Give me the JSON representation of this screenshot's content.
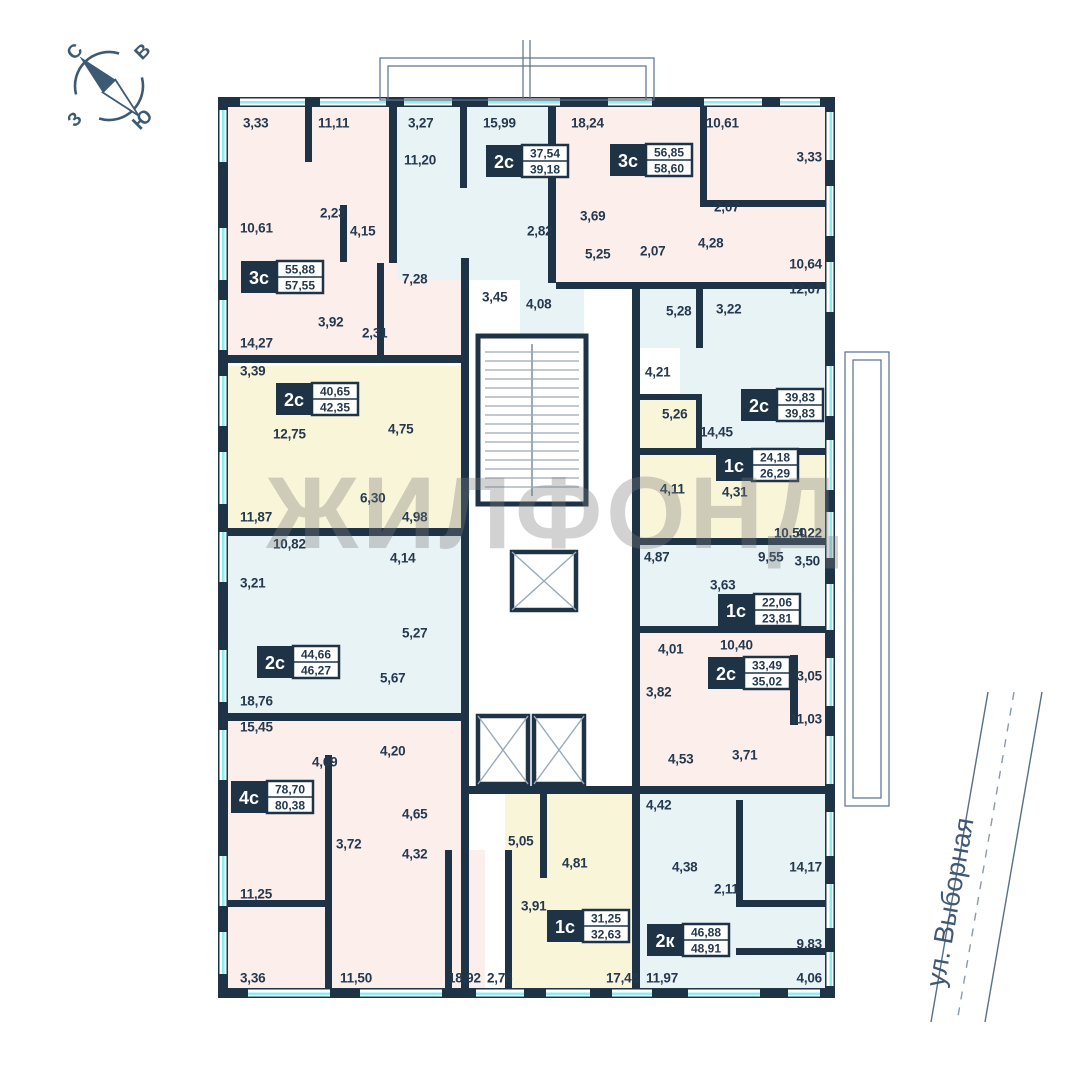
{
  "watermark": "ЖИЛФОНД",
  "street": {
    "name": "ул. Выборная"
  },
  "compass": {
    "north": "С",
    "east": "В",
    "south": "Ю",
    "west": "З"
  },
  "colors": {
    "wall": "#1f3347",
    "pink": "#fcefeb",
    "blue": "#e8f3f5",
    "yellow": "#f9f5d9",
    "glass": "#8ceef0",
    "text": "#24384e",
    "line": "#56708a",
    "stair": "#9aa9b8",
    "white": "#ffffff"
  },
  "plan": {
    "apartments": [
      {
        "type": "3с",
        "area_upper": "55,88",
        "area_lower": "57,55",
        "color": "pink",
        "bx": 283,
        "by": 277,
        "regions": [
          [
            222,
            100,
            171,
            258
          ],
          [
            340,
            205,
            128,
            153
          ]
        ]
      },
      {
        "type": "2с",
        "area_upper": "37,54",
        "area_lower": "39,18",
        "color": "blue",
        "bx": 528,
        "by": 161,
        "regions": [
          [
            397,
            100,
            151,
            85
          ],
          [
            397,
            185,
            155,
            95
          ],
          [
            520,
            280,
            64,
            55
          ]
        ]
      },
      {
        "type": "3с",
        "area_upper": "56,85",
        "area_lower": "58,60",
        "color": "pink",
        "bx": 652,
        "by": 160,
        "regions": [
          [
            556,
            100,
            269,
            182
          ]
        ]
      },
      {
        "type": "2с",
        "area_upper": "39,83",
        "area_lower": "39,83",
        "color": "blue",
        "bx": 783,
        "by": 405,
        "regions": [
          [
            640,
            286,
            185,
            62
          ],
          [
            680,
            348,
            145,
            104
          ]
        ]
      },
      {
        "type": "2с",
        "area_upper": "40,65",
        "area_lower": "42,35",
        "color": "yellow",
        "bx": 318,
        "by": 399,
        "regions": [
          [
            222,
            366,
            243,
            162
          ]
        ]
      },
      {
        "type": "1с",
        "area_upper": "24,18",
        "area_lower": "26,29",
        "color": "yellow",
        "bx": 758,
        "by": 465,
        "regions": [
          [
            638,
            400,
            62,
            52
          ],
          [
            640,
            452,
            185,
            88
          ]
        ]
      },
      {
        "type": "1с",
        "area_upper": "22,06",
        "area_lower": "23,81",
        "color": "blue",
        "bx": 760,
        "by": 610,
        "regions": [
          [
            640,
            540,
            185,
            86
          ]
        ]
      },
      {
        "type": "2с",
        "area_upper": "33,49",
        "area_lower": "35,02",
        "color": "pink",
        "bx": 750,
        "by": 673,
        "regions": [
          [
            640,
            626,
            185,
            160
          ]
        ]
      },
      {
        "type": "2с",
        "area_upper": "44,66",
        "area_lower": "46,27",
        "color": "blue",
        "bx": 299,
        "by": 662,
        "regions": [
          [
            222,
            536,
            243,
            177
          ]
        ]
      },
      {
        "type": "4с",
        "area_upper": "78,70",
        "area_lower": "80,38",
        "color": "pink",
        "bx": 273,
        "by": 797,
        "regions": [
          [
            222,
            721,
            243,
            267
          ],
          [
            443,
            850,
            42,
            138
          ]
        ]
      },
      {
        "type": "1с",
        "area_upper": "31,25",
        "area_lower": "32,63",
        "color": "yellow",
        "bx": 589,
        "by": 926,
        "regions": [
          [
            505,
            793,
            127,
            195
          ]
        ]
      },
      {
        "type": "2к",
        "area_upper": "46,88",
        "area_lower": "48,91",
        "color": "blue",
        "bx": 689,
        "by": 940,
        "regions": [
          [
            640,
            786,
            185,
            202
          ]
        ]
      }
    ],
    "room_labels": [
      {
        "x": 243,
        "y": 123,
        "t": "3,33"
      },
      {
        "x": 318,
        "y": 123,
        "t": "11,11"
      },
      {
        "x": 408,
        "y": 123,
        "t": "3,27"
      },
      {
        "x": 483,
        "y": 123,
        "t": "15,99"
      },
      {
        "x": 571,
        "y": 123,
        "t": "18,24"
      },
      {
        "x": 706,
        "y": 123,
        "t": "10,61"
      },
      {
        "x": 822,
        "y": 157,
        "t": "3,33",
        "e": 1
      },
      {
        "x": 404,
        "y": 160,
        "t": "11,20"
      },
      {
        "x": 320,
        "y": 213,
        "t": "2,23"
      },
      {
        "x": 350,
        "y": 231,
        "t": "4,15"
      },
      {
        "x": 240,
        "y": 228,
        "t": "10,61"
      },
      {
        "x": 580,
        "y": 216,
        "t": "3,69"
      },
      {
        "x": 714,
        "y": 207,
        "t": "2,07"
      },
      {
        "x": 527,
        "y": 231,
        "t": "2,82"
      },
      {
        "x": 585,
        "y": 254,
        "t": "5,25"
      },
      {
        "x": 640,
        "y": 251,
        "t": "2,07"
      },
      {
        "x": 698,
        "y": 243,
        "t": "4,28"
      },
      {
        "x": 822,
        "y": 264,
        "t": "10,64",
        "e": 1
      },
      {
        "x": 240,
        "y": 343,
        "t": "14,27"
      },
      {
        "x": 318,
        "y": 322,
        "t": "3,92"
      },
      {
        "x": 362,
        "y": 333,
        "t": "2,31"
      },
      {
        "x": 402,
        "y": 279,
        "t": "7,28"
      },
      {
        "x": 482,
        "y": 297,
        "t": "3,45"
      },
      {
        "x": 526,
        "y": 304,
        "t": "4,08"
      },
      {
        "x": 822,
        "y": 289,
        "t": "12,67",
        "e": 1
      },
      {
        "x": 666,
        "y": 311,
        "t": "5,28"
      },
      {
        "x": 716,
        "y": 309,
        "t": "3,22"
      },
      {
        "x": 240,
        "y": 371,
        "t": "3,39"
      },
      {
        "x": 645,
        "y": 372,
        "t": "4,21"
      },
      {
        "x": 662,
        "y": 414,
        "t": "5,26"
      },
      {
        "x": 273,
        "y": 434,
        "t": "12,75"
      },
      {
        "x": 388,
        "y": 429,
        "t": "4,75"
      },
      {
        "x": 700,
        "y": 432,
        "t": "14,45"
      },
      {
        "x": 240,
        "y": 517,
        "t": "11,87"
      },
      {
        "x": 360,
        "y": 498,
        "t": "6,30"
      },
      {
        "x": 402,
        "y": 517,
        "t": "4,98"
      },
      {
        "x": 660,
        "y": 489,
        "t": "4,11"
      },
      {
        "x": 722,
        "y": 492,
        "t": "4,31"
      },
      {
        "x": 774,
        "y": 533,
        "t": "10,50"
      },
      {
        "x": 822,
        "y": 533,
        "t": "4,22",
        "e": 1
      },
      {
        "x": 273,
        "y": 544,
        "t": "10,82"
      },
      {
        "x": 240,
        "y": 583,
        "t": "3,21"
      },
      {
        "x": 390,
        "y": 558,
        "t": "4,14"
      },
      {
        "x": 644,
        "y": 557,
        "t": "4,87"
      },
      {
        "x": 758,
        "y": 557,
        "t": "9,55"
      },
      {
        "x": 820,
        "y": 561,
        "t": "3,50",
        "e": 1
      },
      {
        "x": 710,
        "y": 585,
        "t": "3,63"
      },
      {
        "x": 402,
        "y": 633,
        "t": "5,27"
      },
      {
        "x": 380,
        "y": 678,
        "t": "5,67"
      },
      {
        "x": 240,
        "y": 701,
        "t": "18,76"
      },
      {
        "x": 658,
        "y": 649,
        "t": "4,01"
      },
      {
        "x": 720,
        "y": 645,
        "t": "10,40"
      },
      {
        "x": 822,
        "y": 676,
        "t": "3,05",
        "e": 1
      },
      {
        "x": 646,
        "y": 692,
        "t": "3,82"
      },
      {
        "x": 822,
        "y": 719,
        "t": "11,03",
        "e": 1
      },
      {
        "x": 240,
        "y": 727,
        "t": "15,45"
      },
      {
        "x": 312,
        "y": 762,
        "t": "4,69"
      },
      {
        "x": 380,
        "y": 751,
        "t": "4,20"
      },
      {
        "x": 668,
        "y": 759,
        "t": "4,53"
      },
      {
        "x": 732,
        "y": 755,
        "t": "3,71"
      },
      {
        "x": 402,
        "y": 814,
        "t": "4,65"
      },
      {
        "x": 336,
        "y": 844,
        "t": "3,72"
      },
      {
        "x": 402,
        "y": 854,
        "t": "4,32"
      },
      {
        "x": 646,
        "y": 805,
        "t": "4,42"
      },
      {
        "x": 508,
        "y": 841,
        "t": "5,05"
      },
      {
        "x": 562,
        "y": 863,
        "t": "4,81"
      },
      {
        "x": 521,
        "y": 906,
        "t": "3,91"
      },
      {
        "x": 672,
        "y": 867,
        "t": "4,38"
      },
      {
        "x": 714,
        "y": 889,
        "t": "2,11"
      },
      {
        "x": 822,
        "y": 867,
        "t": "14,17",
        "e": 1
      },
      {
        "x": 240,
        "y": 894,
        "t": "11,25"
      },
      {
        "x": 822,
        "y": 944,
        "t": "9,83",
        "e": 1
      },
      {
        "x": 240,
        "y": 978,
        "t": "3,36"
      },
      {
        "x": 340,
        "y": 978,
        "t": "11,50"
      },
      {
        "x": 448,
        "y": 978,
        "t": "18,92"
      },
      {
        "x": 487,
        "y": 978,
        "t": "2,76"
      },
      {
        "x": 606,
        "y": 978,
        "t": "17,48"
      },
      {
        "x": 646,
        "y": 978,
        "t": "11,97"
      },
      {
        "x": 822,
        "y": 978,
        "t": "4,06",
        "e": 1
      }
    ],
    "walls": [
      [
        218,
        97,
        617,
        10
      ],
      [
        218,
        988,
        617,
        10
      ],
      [
        218,
        97,
        10,
        901
      ],
      [
        825,
        97,
        10,
        901
      ],
      [
        305,
        100,
        7,
        62
      ],
      [
        389,
        100,
        8,
        163
      ],
      [
        460,
        100,
        7,
        88
      ],
      [
        548,
        100,
        8,
        183
      ],
      [
        700,
        100,
        7,
        104
      ],
      [
        700,
        200,
        125,
        7
      ],
      [
        340,
        205,
        7,
        57
      ],
      [
        377,
        263,
        7,
        95
      ],
      [
        461,
        258,
        8,
        105
      ],
      [
        222,
        355,
        247,
        8
      ],
      [
        222,
        528,
        247,
        8
      ],
      [
        222,
        713,
        247,
        8
      ],
      [
        556,
        282,
        269,
        7
      ],
      [
        696,
        286,
        7,
        62
      ],
      [
        632,
        282,
        8,
        706
      ],
      [
        461,
        358,
        8,
        630
      ],
      [
        632,
        448,
        201,
        7
      ],
      [
        632,
        538,
        201,
        7
      ],
      [
        632,
        626,
        201,
        7
      ],
      [
        790,
        655,
        8,
        70
      ],
      [
        461,
        786,
        372,
        8
      ],
      [
        736,
        800,
        7,
        100
      ],
      [
        736,
        900,
        97,
        7
      ],
      [
        736,
        948,
        97,
        7
      ],
      [
        540,
        793,
        7,
        85
      ],
      [
        505,
        850,
        7,
        138
      ],
      [
        445,
        850,
        7,
        138
      ],
      [
        325,
        755,
        7,
        233
      ],
      [
        222,
        900,
        110,
        7
      ],
      [
        638,
        394,
        64,
        6
      ],
      [
        696,
        394,
        6,
        58
      ]
    ],
    "windows": {
      "top": [
        [
          240,
          305
        ],
        [
          320,
          386
        ],
        [
          404,
          452
        ],
        [
          488,
          560
        ],
        [
          608,
          652
        ],
        [
          704,
          762
        ],
        [
          780,
          820
        ]
      ],
      "left": [
        [
          110,
          162
        ],
        [
          228,
          280
        ],
        [
          300,
          350
        ],
        [
          376,
          426
        ],
        [
          452,
          504
        ],
        [
          532,
          582
        ],
        [
          650,
          702
        ],
        [
          730,
          780
        ],
        [
          856,
          906
        ],
        [
          932,
          974
        ]
      ],
      "right": [
        [
          112,
          160
        ],
        [
          186,
          236
        ],
        [
          262,
          312
        ],
        [
          366,
          416
        ],
        [
          440,
          490
        ],
        [
          512,
          558
        ],
        [
          584,
          630
        ],
        [
          658,
          706
        ],
        [
          736,
          784
        ],
        [
          812,
          856
        ],
        [
          884,
          928
        ],
        [
          952,
          986
        ]
      ],
      "bottom": [
        [
          248,
          330
        ],
        [
          360,
          442
        ],
        [
          476,
          524
        ],
        [
          546,
          590
        ],
        [
          612,
          652
        ],
        [
          688,
          760
        ],
        [
          788,
          820
        ]
      ]
    },
    "balconies": [
      [
        380,
        58,
        274,
        42
      ],
      [
        388,
        66,
        258,
        34
      ],
      [
        845,
        352,
        44,
        454
      ],
      [
        853,
        360,
        28,
        438
      ]
    ],
    "balcony_lines": [
      [
        523,
        40,
        523,
        99
      ],
      [
        530,
        40,
        530,
        99
      ]
    ],
    "core": {
      "stairs": {
        "x": 478,
        "y": 336,
        "w": 108,
        "h": 168
      },
      "elevators": [
        [
          512,
          552,
          64,
          58
        ],
        [
          478,
          716,
          50,
          68
        ],
        [
          534,
          716,
          50,
          68
        ]
      ]
    }
  }
}
